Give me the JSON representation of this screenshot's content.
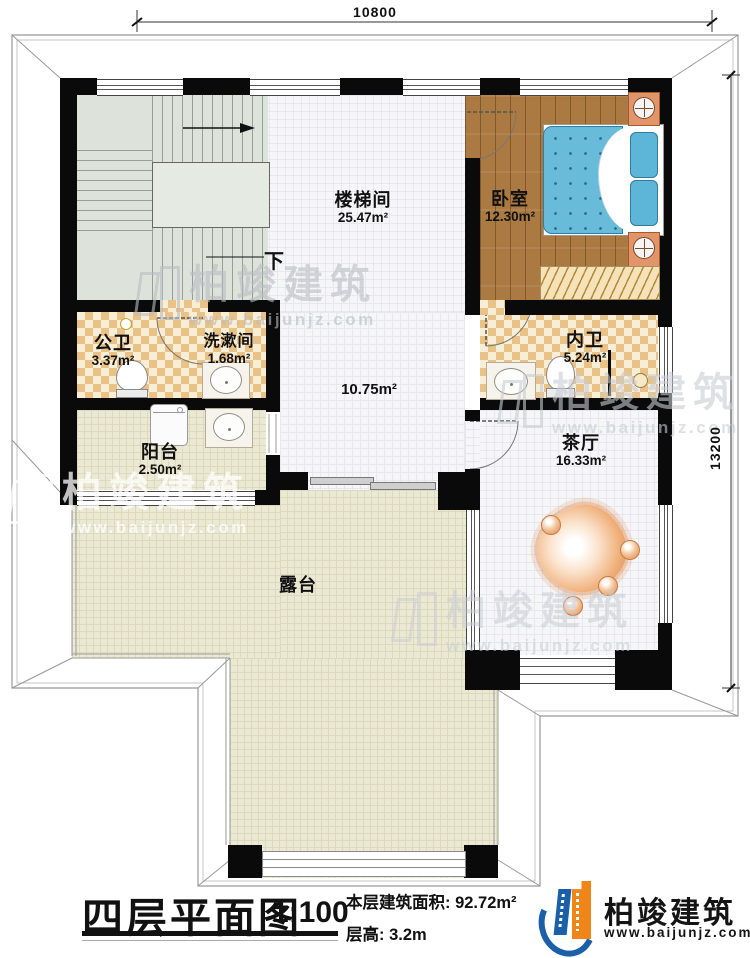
{
  "dimensions": {
    "top": "10800",
    "right": "13200"
  },
  "stair": {
    "down_label": "下"
  },
  "rooms": {
    "staircase": {
      "name": "楼梯间",
      "area": "25.47m²"
    },
    "bedroom": {
      "name": "卧室",
      "area": "12.30m²"
    },
    "public_bath": {
      "name": "公卫",
      "area": "3.37m²"
    },
    "washroom": {
      "name": "洗漱间",
      "area": "1.68m²"
    },
    "inner_bath": {
      "name": "内卫",
      "area": "5.24m²"
    },
    "balcony": {
      "name": "阳台",
      "area": "2.50m²"
    },
    "tea_hall": {
      "name": "茶厅",
      "area": "16.33m²"
    },
    "hall": {
      "area": "10.75m²"
    },
    "terrace": {
      "name": "露台"
    }
  },
  "title_block": {
    "title": "四层平面图",
    "scale": "1:100",
    "floor_area": "本层建筑面积: 92.72m²",
    "floor_height": "层高: 3.2m"
  },
  "brand": {
    "name": "柏竣建筑",
    "website": "www.baijunjz.com"
  },
  "watermark": {
    "name": "柏竣建筑",
    "website": "www.baijunjz.com"
  },
  "colors": {
    "brand_blue": "#1a5fa8",
    "brand_orange": "#f08519",
    "wall": "#0a0a0a",
    "wood_floor": "#ab7a42",
    "checker_dark": "#e9c287",
    "checker_light": "#f8eed6",
    "bed_blue": "#68bbd9",
    "terrace_floor": "#ebe9d4",
    "furniture_orange": "#e2956b"
  }
}
